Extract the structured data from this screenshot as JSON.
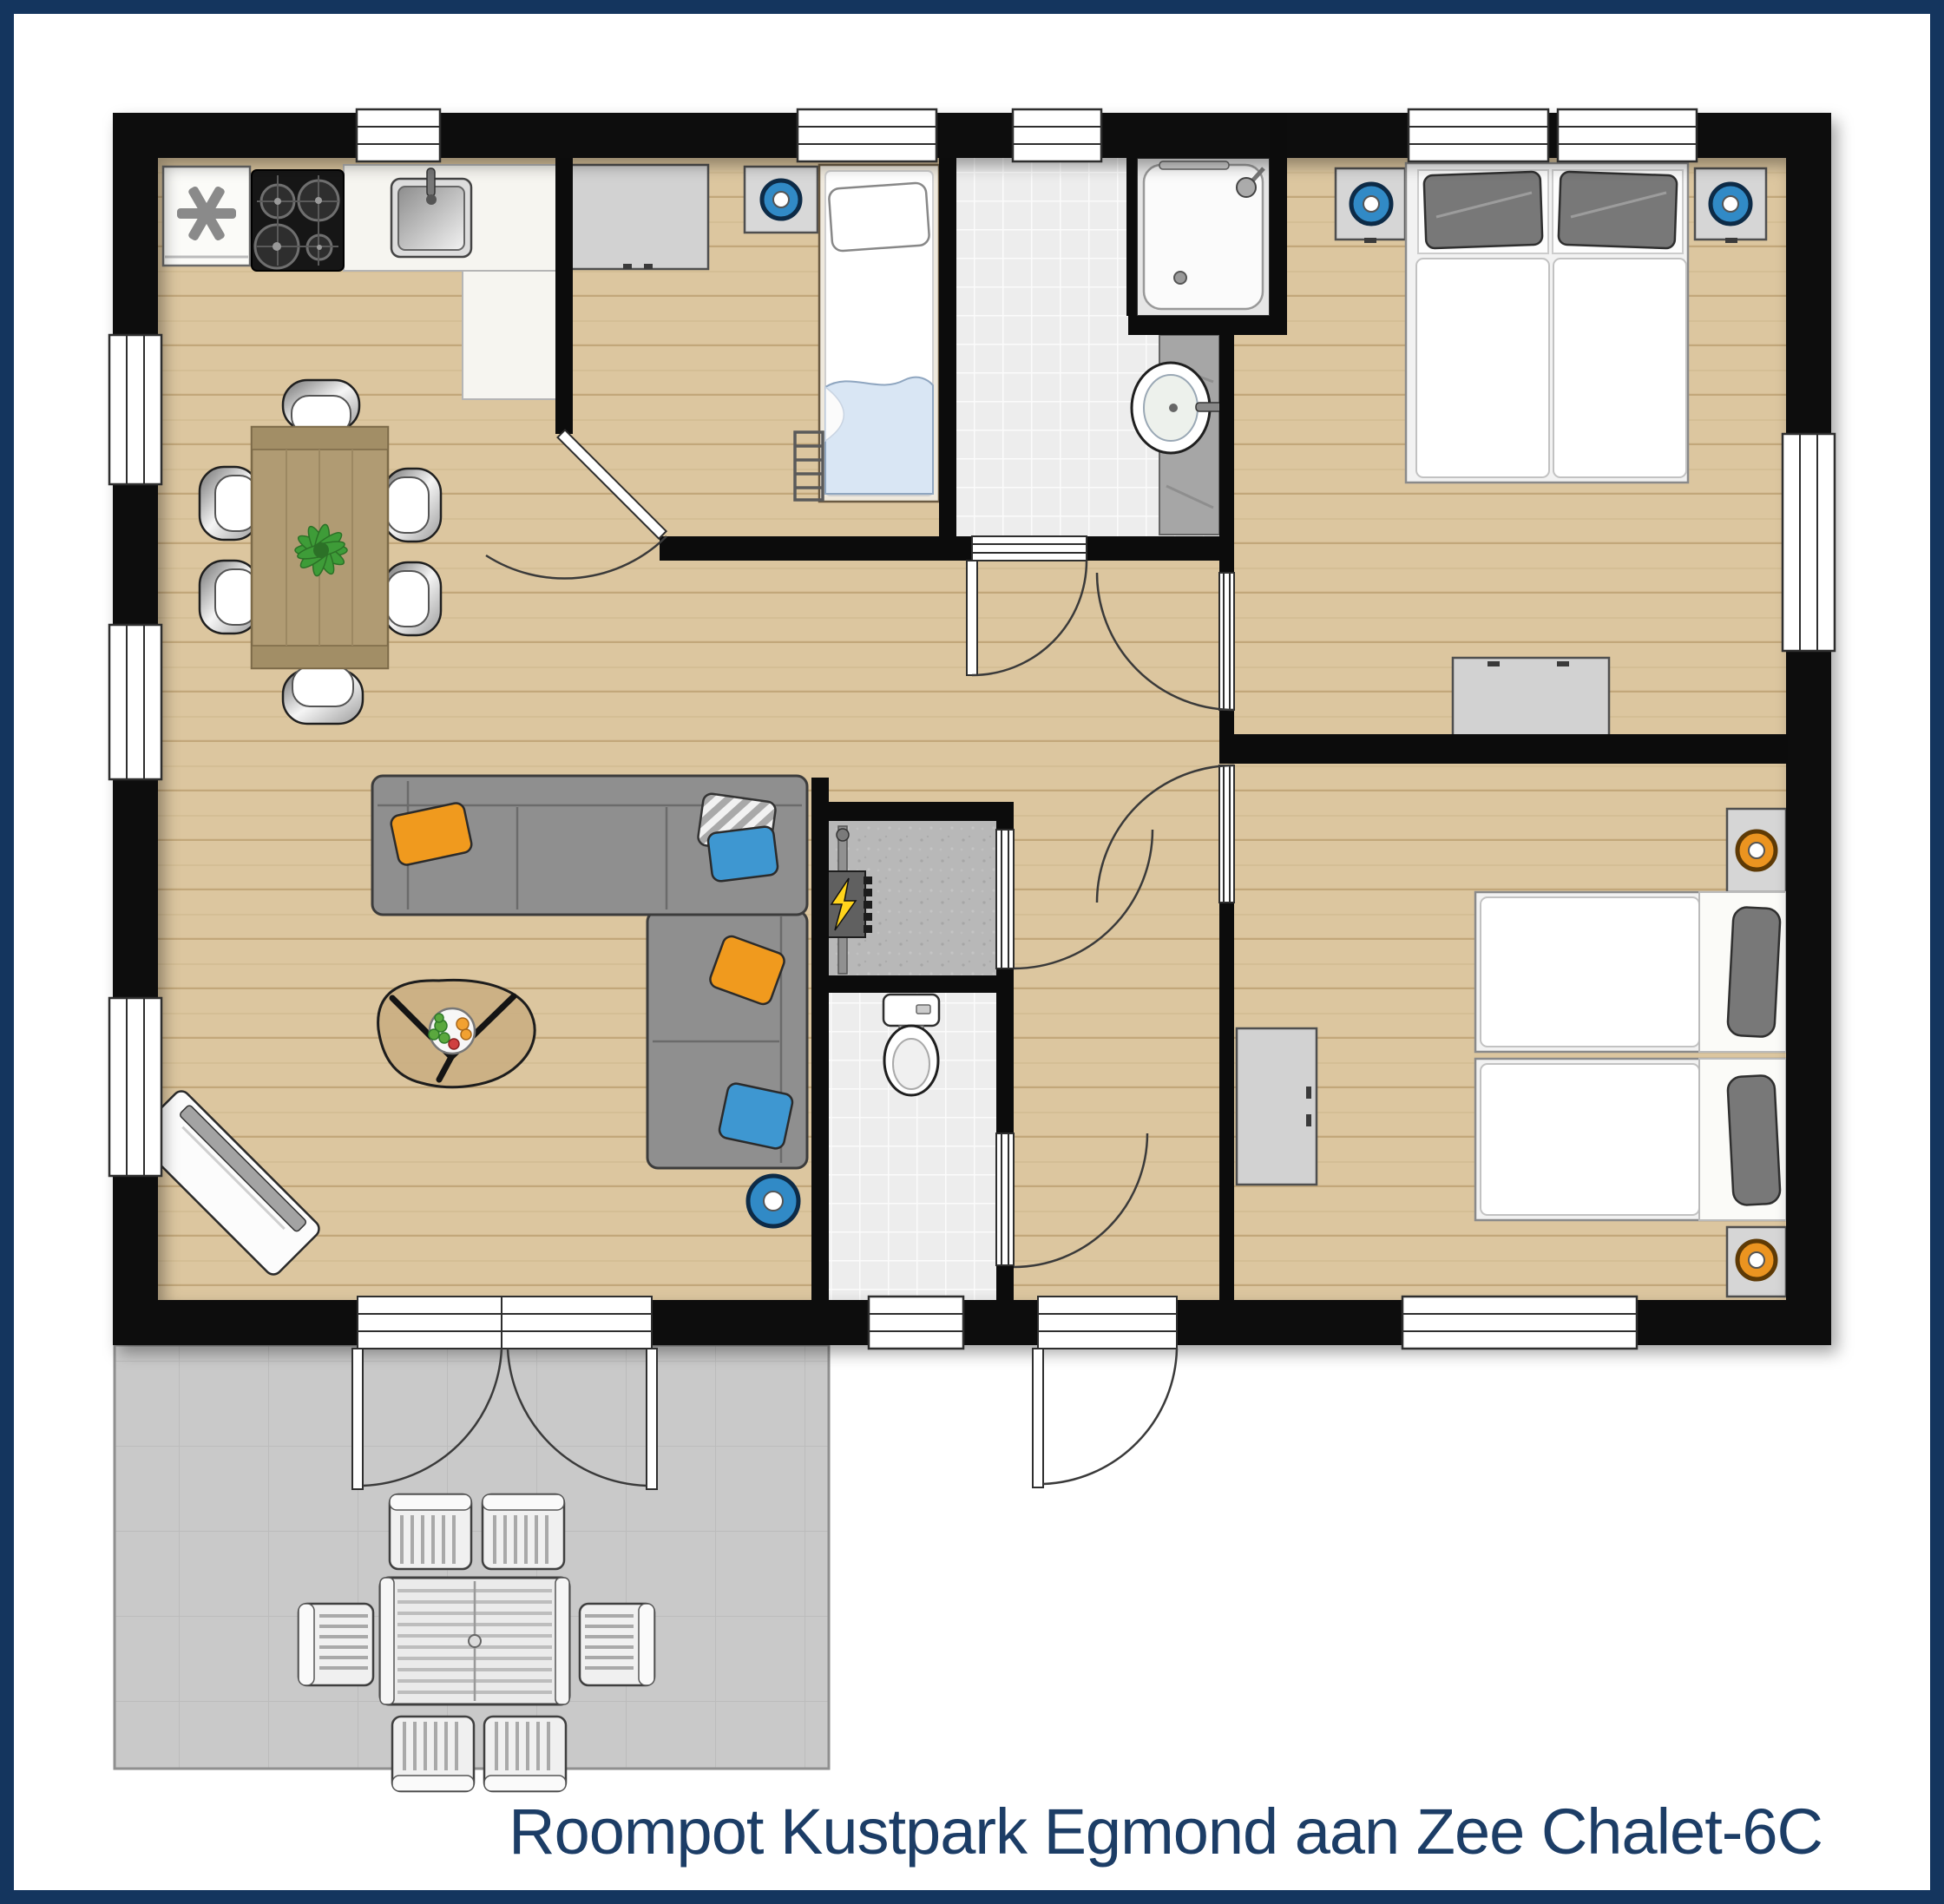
{
  "title": {
    "text": "Roompot Kustpark Egmond aan Zee Chalet-6C"
  },
  "colors": {
    "frame_navy": "#14355e",
    "title_navy": "#1c3d66",
    "wall_black": "#0c0c0c",
    "wood_floor": "#dcc69f",
    "wood_plank_line": "#c2a77a",
    "tile_floor": "#ededed",
    "terrace_gray": "#c9c9c9",
    "sofa_gray": "#8f8f8f",
    "pillow_orange": "#f09a1e",
    "pillow_blue": "#3e97d1",
    "lamp_blue": "#318ac6",
    "lamp_orange": "#eb9420",
    "plant_green": "#3e9c38",
    "table_wood": "#b09b73",
    "bolt_yellow": "#ffd41c"
  },
  "rooms": [
    {
      "id": "kitchen",
      "furniture": [
        "fridge-freezer",
        "gas-hob",
        "kitchen-sink",
        "counter"
      ]
    },
    {
      "id": "dining-area",
      "furniture": [
        "dining-table",
        "six-chairs",
        "plant"
      ]
    },
    {
      "id": "living-room",
      "furniture": [
        "corner-sofa",
        "four-cushions",
        "coffee-table",
        "fruit-bowl",
        "tv-sideboard",
        "floor-lamp"
      ]
    },
    {
      "id": "bedroom-front",
      "furniture": [
        "single-bed",
        "ladder",
        "wardrobe",
        "nightstand",
        "blue-lamp"
      ]
    },
    {
      "id": "bathroom",
      "furniture": [
        "shower-cabin",
        "washbasin",
        "vanity"
      ]
    },
    {
      "id": "bedroom-master",
      "furniture": [
        "double-bed",
        "two-nightstands",
        "two-blue-lamps",
        "dresser"
      ]
    },
    {
      "id": "bedroom-twin",
      "furniture": [
        "two-single-beds",
        "two-nightstands",
        "two-orange-lamps",
        "wardrobe"
      ]
    },
    {
      "id": "toilet-room",
      "furniture": [
        "toilet"
      ]
    },
    {
      "id": "storage-closet",
      "furniture": [
        "electrical-panel"
      ]
    },
    {
      "id": "hallway",
      "furniture": []
    },
    {
      "id": "terrace",
      "furniture": [
        "garden-table",
        "six-garden-chairs"
      ]
    }
  ]
}
